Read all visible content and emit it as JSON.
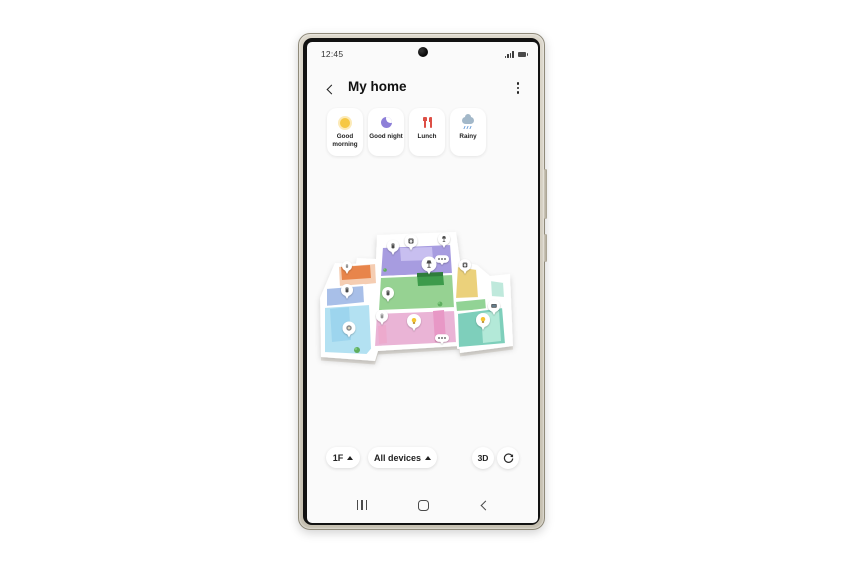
{
  "status_bar": {
    "time": "12:45",
    "signal_icon": "signal-bars",
    "battery_icon": "battery-full"
  },
  "header": {
    "title": "My home",
    "back_icon": "chevron-left",
    "menu_icon": "kebab-menu"
  },
  "scenes": [
    {
      "label": "Good morning",
      "icon": "sun",
      "color": "#f6c844"
    },
    {
      "label": "Good night",
      "icon": "crescent-moon",
      "color": "#8d7fd8"
    },
    {
      "label": "Lunch",
      "icon": "fork-and-knife",
      "color": "#dd4f46"
    },
    {
      "label": "Rainy",
      "icon": "rain-cloud",
      "color": "#a3b8c9"
    }
  ],
  "controls": {
    "floor_label": "1F",
    "floor_arrow": "up-triangle",
    "devices_label": "All devices",
    "devices_arrow": "up-triangle",
    "view3d_label": "3D",
    "rotate_icon": "rotate-arrow"
  },
  "nav_bar": {
    "recents_icon": "three-bars",
    "home_icon": "rounded-square",
    "back_icon": "chevron-left"
  },
  "floorplan": {
    "slab": "M63,14 L142,11 L146,40 L163,44 L176,55 L196,53 L199,125 L146,132 L145,125 L64,130 L61,140 L7,136 L6,77 L21,42 L42,43 L43,37 L62,38 Z",
    "rooms": [
      {
        "name": "laundry-room",
        "color": "#a79ce0",
        "points": [
          [
            68,
            26
          ],
          [
            137,
            23
          ],
          [
            139,
            53
          ],
          [
            66,
            56
          ]
        ]
      },
      {
        "name": "living-room",
        "color": "#96d292",
        "points": [
          [
            66,
            56
          ],
          [
            139,
            53
          ],
          [
            141,
            87
          ],
          [
            64,
            90
          ]
        ]
      },
      {
        "name": "bedroom-pink",
        "color": "#eab4d6",
        "points": [
          [
            62,
            92
          ],
          [
            141,
            89
          ],
          [
            143,
            122
          ],
          [
            60,
            126
          ]
        ]
      },
      {
        "name": "nook-salmon",
        "color": "#f5cdb2",
        "points": [
          [
            24,
            45
          ],
          [
            62,
            42
          ],
          [
            63,
            63
          ],
          [
            25,
            67
          ]
        ]
      },
      {
        "name": "hallway-blue",
        "color": "#a8bfe8",
        "points": [
          [
            12,
            67
          ],
          [
            50,
            64
          ],
          [
            51,
            82
          ],
          [
            12,
            86
          ]
        ]
      },
      {
        "name": "bedroom-cyan",
        "color": "#b3e1f2",
        "points": [
          [
            10,
            86
          ],
          [
            56,
            83
          ],
          [
            58,
            128
          ],
          [
            53,
            134
          ],
          [
            10,
            132
          ]
        ]
      },
      {
        "name": "kitchen-yellow",
        "color": "#ebd17b",
        "points": [
          [
            143,
            45
          ],
          [
            163,
            48
          ],
          [
            165,
            77
          ],
          [
            141,
            78
          ]
        ]
      },
      {
        "name": "hallway-green",
        "color": "#92d395",
        "points": [
          [
            141,
            80
          ],
          [
            172,
            77
          ],
          [
            173,
            89
          ],
          [
            142,
            91
          ]
        ]
      },
      {
        "name": "bedroom-teal",
        "color": "#7ecfbb",
        "points": [
          [
            143,
            92
          ],
          [
            189,
            86
          ],
          [
            192,
            123
          ],
          [
            144,
            127
          ]
        ]
      },
      {
        "name": "closet-mint",
        "color": "#bfe9dc",
        "points": [
          [
            176,
            59
          ],
          [
            190,
            61
          ],
          [
            191,
            77
          ],
          [
            177,
            76
          ]
        ]
      }
    ],
    "furniture": [
      {
        "name": "piano",
        "color": "#c8bff0",
        "points": [
          [
            86,
            27
          ],
          [
            118,
            26
          ],
          [
            119,
            39
          ],
          [
            87,
            40
          ]
        ]
      },
      {
        "name": "sofa-green",
        "color": "#3d9b4b",
        "points": [
          [
            103,
            54
          ],
          [
            129,
            53
          ],
          [
            130,
            64
          ],
          [
            104,
            65
          ]
        ]
      },
      {
        "name": "sofa-green-back",
        "color": "#2f7d3c",
        "points": [
          [
            103,
            52
          ],
          [
            129,
            51
          ],
          [
            129,
            55
          ],
          [
            103,
            56
          ]
        ]
      },
      {
        "name": "couch-orange",
        "color": "#e8854b",
        "points": [
          [
            27,
            46
          ],
          [
            56,
            44
          ],
          [
            57,
            57
          ],
          [
            28,
            59
          ]
        ]
      },
      {
        "name": "bed-blue",
        "color": "#9dd5ee",
        "points": [
          [
            16,
            88
          ],
          [
            35,
            86
          ],
          [
            37,
            119
          ],
          [
            18,
            121
          ]
        ]
      },
      {
        "name": "couch-pink",
        "color": "#e898c6",
        "points": [
          [
            119,
            90
          ],
          [
            130,
            89
          ],
          [
            132,
            120
          ],
          [
            121,
            121
          ]
        ]
      },
      {
        "name": "bench-pink",
        "color": "#edaacd",
        "points": [
          [
            64,
            105
          ],
          [
            72,
            104
          ],
          [
            73,
            122
          ],
          [
            65,
            123
          ]
        ]
      },
      {
        "name": "bed-mint",
        "color": "#b3e9d8",
        "points": [
          [
            167,
            92
          ],
          [
            185,
            90
          ],
          [
            187,
            120
          ],
          [
            169,
            122
          ]
        ]
      }
    ],
    "plants": [
      {
        "name": "plant",
        "x": 126,
        "y": 83,
        "r": 2.4
      },
      {
        "name": "plant",
        "x": 43,
        "y": 129,
        "r": 3
      },
      {
        "name": "plant",
        "x": 71,
        "y": 49,
        "r": 1.8
      }
    ],
    "pins": [
      {
        "icon": "appliance",
        "x": 79,
        "y": 25,
        "r": 6
      },
      {
        "icon": "washer",
        "x": 97,
        "y": 20,
        "r": 6.5
      },
      {
        "icon": "floor-lamp",
        "x": 130,
        "y": 18,
        "r": 6
      },
      {
        "icon": "speaker-dots",
        "x": 128,
        "y": 38,
        "r": 0
      },
      {
        "icon": "floor-lamp",
        "x": 115,
        "y": 43,
        "r": 7.5
      },
      {
        "icon": "oven",
        "x": 151,
        "y": 44,
        "r": 6
      },
      {
        "icon": "air-purifier",
        "x": 33,
        "y": 45,
        "r": 5
      },
      {
        "icon": "appliance",
        "x": 33,
        "y": 69,
        "r": 6
      },
      {
        "icon": "appliance",
        "x": 74,
        "y": 72,
        "r": 6
      },
      {
        "icon": "air-purifier",
        "x": 68,
        "y": 95,
        "r": 6
      },
      {
        "icon": "tv",
        "x": 180,
        "y": 85,
        "r": 6
      },
      {
        "icon": "bulb",
        "x": 169,
        "y": 99,
        "r": 7
      },
      {
        "icon": "bulb",
        "x": 100,
        "y": 100,
        "r": 7
      },
      {
        "icon": "robot-vacuum",
        "x": 35,
        "y": 107,
        "r": 6.5
      },
      {
        "icon": "speaker-dots",
        "x": 128,
        "y": 117,
        "r": 0
      }
    ]
  }
}
